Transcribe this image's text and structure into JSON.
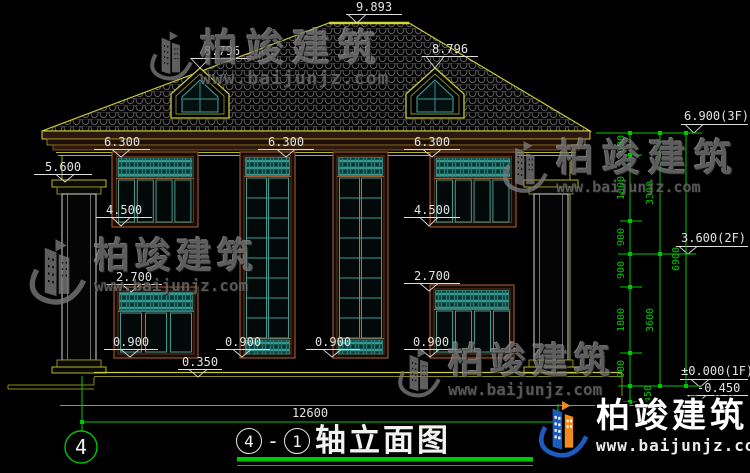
{
  "colors": {
    "cad_yellow": "#b5b52a",
    "cad_green": "#00c800",
    "teal": "#3d9b94",
    "frame_brown": "#a05a32",
    "dim_white": "#e2e2e2",
    "watermark_gray": "#787878",
    "logo_blue": "#1c5bbf",
    "logo_orange": "#f08c1e"
  },
  "dims": {
    "ridge": "9.893",
    "dormer_left": "8.796",
    "dormer_right": "8.796",
    "eave": [
      "6.300",
      "6.300",
      "6.300"
    ],
    "eave_left": "5.600",
    "sill2f": [
      "4.500",
      "4.500"
    ],
    "head1f": [
      "2.700",
      "2.700"
    ],
    "sill1f": [
      "0.900",
      "0.900",
      "0.900",
      "0.900"
    ],
    "plinth": "0.350",
    "overall_width": "12600"
  },
  "levels": {
    "f3": "6.900(3F)",
    "f2": "3.600(2F)",
    "f1": "±0.000(1F)",
    "neg": "-0.450"
  },
  "chain": {
    "segments": [
      "600",
      "1800",
      "900",
      "900",
      "1800",
      "900",
      "450"
    ],
    "floors": [
      "3300",
      "3600"
    ],
    "total": "6900"
  },
  "title_block": {
    "axis_bubble": "4",
    "axis_start": "4",
    "dash": "-",
    "axis_end": "1",
    "title": "轴立面图"
  },
  "watermark": {
    "brand": "柏竣建筑",
    "url": "www.baijunjz.com"
  }
}
